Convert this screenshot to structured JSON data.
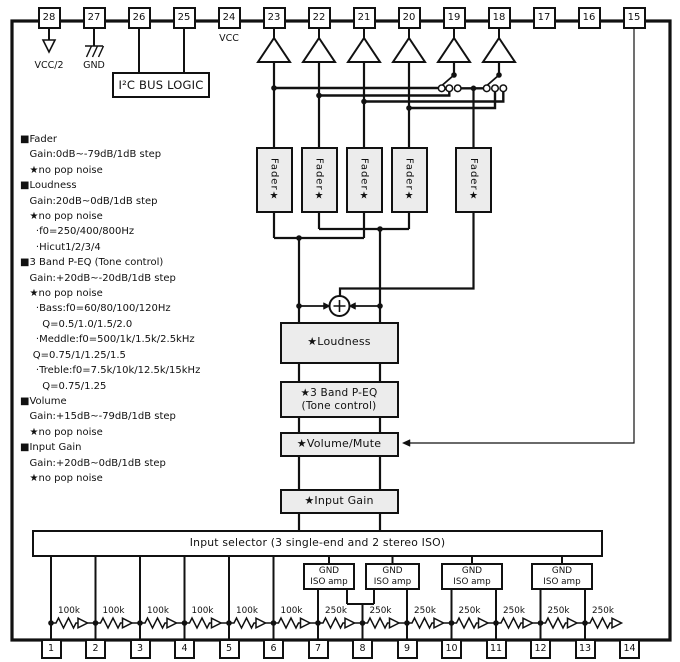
{
  "pins": {
    "top": [
      "28",
      "27",
      "26",
      "25",
      "24",
      "23",
      "22",
      "21",
      "20",
      "19",
      "18",
      "17",
      "16",
      "15"
    ],
    "bottom": [
      "1",
      "2",
      "3",
      "4",
      "5",
      "6",
      "7",
      "8",
      "9",
      "10",
      "11",
      "12",
      "13",
      "14"
    ]
  },
  "power": {
    "vcc_half": "VCC/2",
    "gnd": "GND",
    "vcc": "VCC"
  },
  "blocks": {
    "i2c": "I²C BUS LOGIC",
    "fader": "Fader★",
    "loudness": "★Loudness",
    "peq_line1": "★3 Band P-EQ",
    "peq_line2": "(Tone control)",
    "volume_mute": "★Volume/Mute",
    "input_gain": "★Input Gain",
    "input_selector": "Input selector (3 single-end and 2 stereo ISO)",
    "iso_amp_line1": "GND",
    "iso_amp_line2": "ISO amp"
  },
  "resistor_labels": [
    "100k",
    "100k",
    "100k",
    "100k",
    "100k",
    "100k",
    "250k",
    "250k",
    "250k",
    "250k",
    "250k",
    "250k",
    "250k"
  ],
  "spec_lines": [
    "■Fader",
    "   Gain:0dB~-79dB/1dB step",
    "   ★no pop noise",
    "■Loudness",
    "   Gain:20dB~0dB/1dB step",
    "   ★no pop noise",
    "     ·f0=250/400/800Hz",
    "     ·Hicut1/2/3/4",
    "■3 Band P-EQ (Tone control)",
    "   Gain:+20dB~-20dB/1dB step",
    "   ★no pop noise",
    "     ·Bass:f0=60/80/100/120Hz",
    "       Q=0.5/1.0/1.5/2.0",
    "     ·Meddle:f0=500/1k/1.5k/2.5kHz",
    "    Q=0.75/1/1.25/1.5",
    "     ·Treble:f0=7.5k/10k/12.5k/15kHz",
    "       Q=0.75/1.25",
    "■Volume",
    "   Gain:+15dB~-79dB/1dB step",
    "   ★no pop noise",
    "■Input Gain",
    "   Gain:+20dB~0dB/1dB step",
    "   ★no pop noise"
  ],
  "colors": {
    "ink": "#111111",
    "box_fill": "#ececec",
    "background": "#ffffff"
  }
}
